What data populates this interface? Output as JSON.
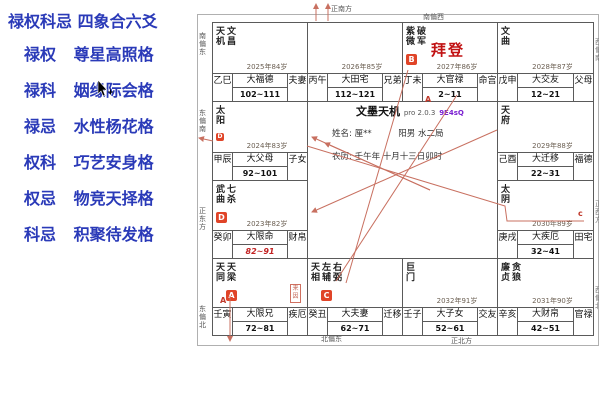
{
  "left_panel": {
    "title": "禄权科忌 四象合六爻",
    "items": [
      {
        "pair": "禄权",
        "name": "尊星高照格"
      },
      {
        "pair": "禄科",
        "name": "姻缘际会格"
      },
      {
        "pair": "禄忌",
        "name": "水性杨花格"
      },
      {
        "pair": "权科",
        "name": "巧艺安身格"
      },
      {
        "pair": "权忌",
        "name": "物竞天择格"
      },
      {
        "pair": "科忌",
        "name": "积聚待发格"
      }
    ],
    "text_color": "#2a3ab8"
  },
  "chart": {
    "app": {
      "title": "文墨天机",
      "version": "pro 2.0.3",
      "code": "9E4sQ"
    },
    "person": {
      "name_line": "姓名: 厘**",
      "gender_bureau": "阳男 水二局",
      "lunar_line": "农历: 壬午年 十月十三日卯时",
      "highlight_name": "拜登"
    },
    "palaces": [
      {
        "col": 0,
        "row": 0,
        "stars": [
          "天机",
          "文昌"
        ],
        "year": "2025年84岁",
        "stem": "乙巳",
        "decade": "大福德",
        "range": "102~111",
        "palace": "夫妻"
      },
      {
        "col": 1,
        "row": 0,
        "stars": [],
        "year": "2026年85岁",
        "stem": "丙午",
        "decade": "大田宅",
        "range": "112~121",
        "palace": "兄弟"
      },
      {
        "col": 2,
        "row": 0,
        "stars": [
          "紫微",
          "破军"
        ],
        "badge": {
          "letter": "B",
          "under": 0
        },
        "special": "拜登",
        "year": "2027年86岁",
        "stem": "丁未",
        "decade": "大官禄",
        "range": "2~11",
        "palace": "命宫"
      },
      {
        "col": 3,
        "row": 0,
        "stars": [
          "文曲"
        ],
        "year": "2028年87岁",
        "stem": "戊申",
        "decade": "大交友",
        "range": "12~21",
        "palace": "父母"
      },
      {
        "col": 3,
        "row": 1,
        "stars": [
          "天府"
        ],
        "year": "2029年88岁",
        "stem": "己酉",
        "decade": "大迁移",
        "range": "22~31",
        "palace": "福德"
      },
      {
        "col": 3,
        "row": 2,
        "stars": [
          "太阴"
        ],
        "year": "2030年89岁",
        "stem": "庚戌",
        "decade": "大疾厄",
        "range": "32~41",
        "palace": "田宅"
      },
      {
        "col": 3,
        "row": 3,
        "stars": [
          "廉贞",
          "贪狼"
        ],
        "year": "2031年90岁",
        "stem": "辛亥",
        "decade": "大财帛",
        "range": "42~51",
        "palace": "官禄"
      },
      {
        "col": 2,
        "row": 3,
        "stars": [
          "巨门"
        ],
        "year": "2032年91岁",
        "stem": "壬子",
        "decade": "大子女",
        "range": "52~61",
        "palace": "交友"
      },
      {
        "col": 1,
        "row": 3,
        "stars": [
          "天相",
          "左辅",
          "右弼"
        ],
        "badge": {
          "letter": "C",
          "under": 1
        },
        "stem": "癸丑",
        "decade": "大夫妻",
        "range": "62~71",
        "palace": "迁移"
      },
      {
        "col": 0,
        "row": 3,
        "stars": [
          "天同",
          "天梁"
        ],
        "badge": {
          "letter": "A",
          "under": 1
        },
        "stamp": "来因",
        "stem": "壬寅",
        "decade": "大限兄",
        "range": "72~81",
        "palace": "疾厄"
      },
      {
        "col": 0,
        "row": 2,
        "stars": [
          "武曲",
          "七杀"
        ],
        "badge": {
          "letter": "D",
          "under": 0
        },
        "year": "2023年82岁",
        "stem": "癸卯",
        "decade": "大限命",
        "range": "82~91",
        "range_red": true,
        "palace": "财帛"
      },
      {
        "col": 0,
        "row": 1,
        "stars": [
          "太阳"
        ],
        "badge": {
          "letter": "D",
          "under": 0,
          "small": true
        },
        "year": "2024年83岁",
        "stem": "甲辰",
        "decade": "大父母",
        "range": "92~101",
        "palace": "子女"
      }
    ],
    "directions": {
      "top": [
        {
          "text": "正南方",
          "x": 331,
          "y": 4
        },
        {
          "text": "南偏西",
          "x": 423,
          "y": 12
        }
      ],
      "left": [
        {
          "text": "南偏东",
          "y": 32
        },
        {
          "text": "东偏南",
          "y": 109
        },
        {
          "text": "正东方",
          "y": 207
        },
        {
          "text": "东偏北",
          "y": 305
        }
      ],
      "bottom": [
        {
          "text": "北偏东",
          "x": 321,
          "y": 334
        },
        {
          "text": "正北方",
          "x": 451,
          "y": 336
        }
      ],
      "right_clipped": [
        {
          "text": "西偏南",
          "y": 38
        },
        {
          "text": "正西方",
          "y": 200
        },
        {
          "text": "西偏北",
          "y": 286
        }
      ]
    },
    "line_labels": [
      {
        "text": "A",
        "x": 425,
        "y": 95
      },
      {
        "text": "A",
        "x": 220,
        "y": 296
      },
      {
        "text": "c",
        "x": 578,
        "y": 209
      }
    ],
    "accent_red": "#e04428",
    "line_red": "#c87060"
  }
}
